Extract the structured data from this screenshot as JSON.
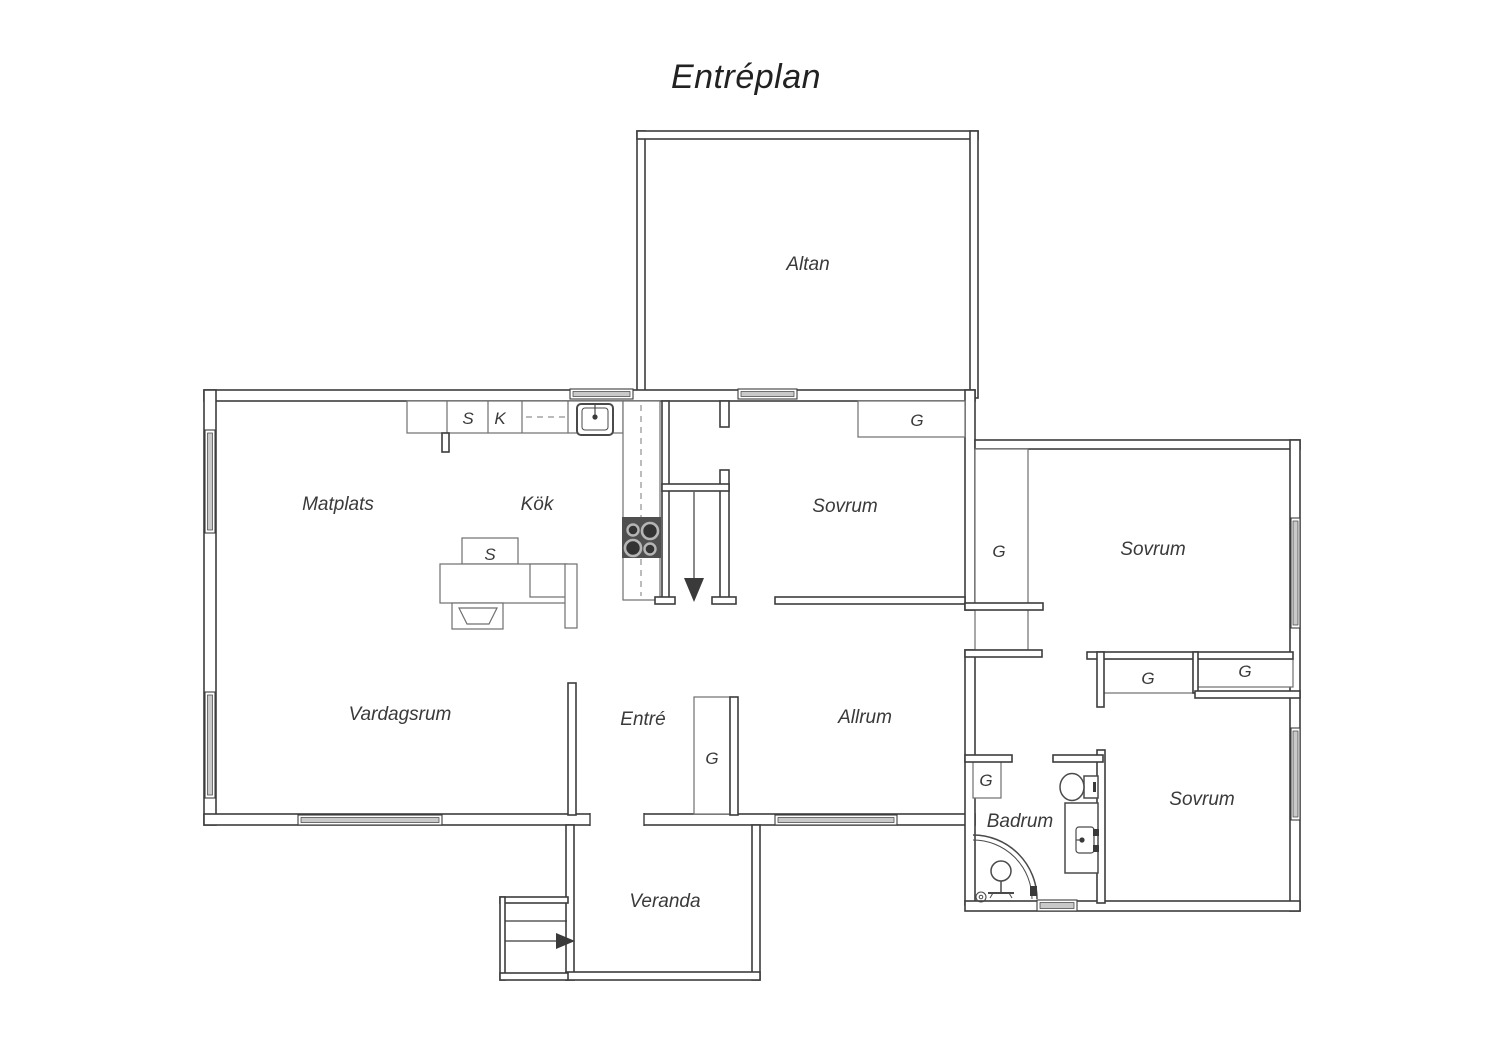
{
  "title": "Entréplan",
  "rooms": {
    "altan": "Altan",
    "matplats": "Matplats",
    "kok": "Kök",
    "sovrum_1": "Sovrum",
    "sovrum_2": "Sovrum",
    "sovrum_3": "Sovrum",
    "vardagsrum": "Vardagsrum",
    "entre": "Entré",
    "allrum": "Allrum",
    "badrum": "Badrum",
    "veranda": "Veranda"
  },
  "markers": {
    "closet": "G",
    "cabinet_s": "S",
    "cabinet_k": "K",
    "island_s": "S"
  },
  "colors": {
    "wall_line": "#3d3d3d",
    "thin_line": "#6f6f6f",
    "window_fill": "#c9c9c9",
    "stove_fill": "#4f4f4f",
    "label_text": "#3a3a3a",
    "background": "#ffffff"
  }
}
